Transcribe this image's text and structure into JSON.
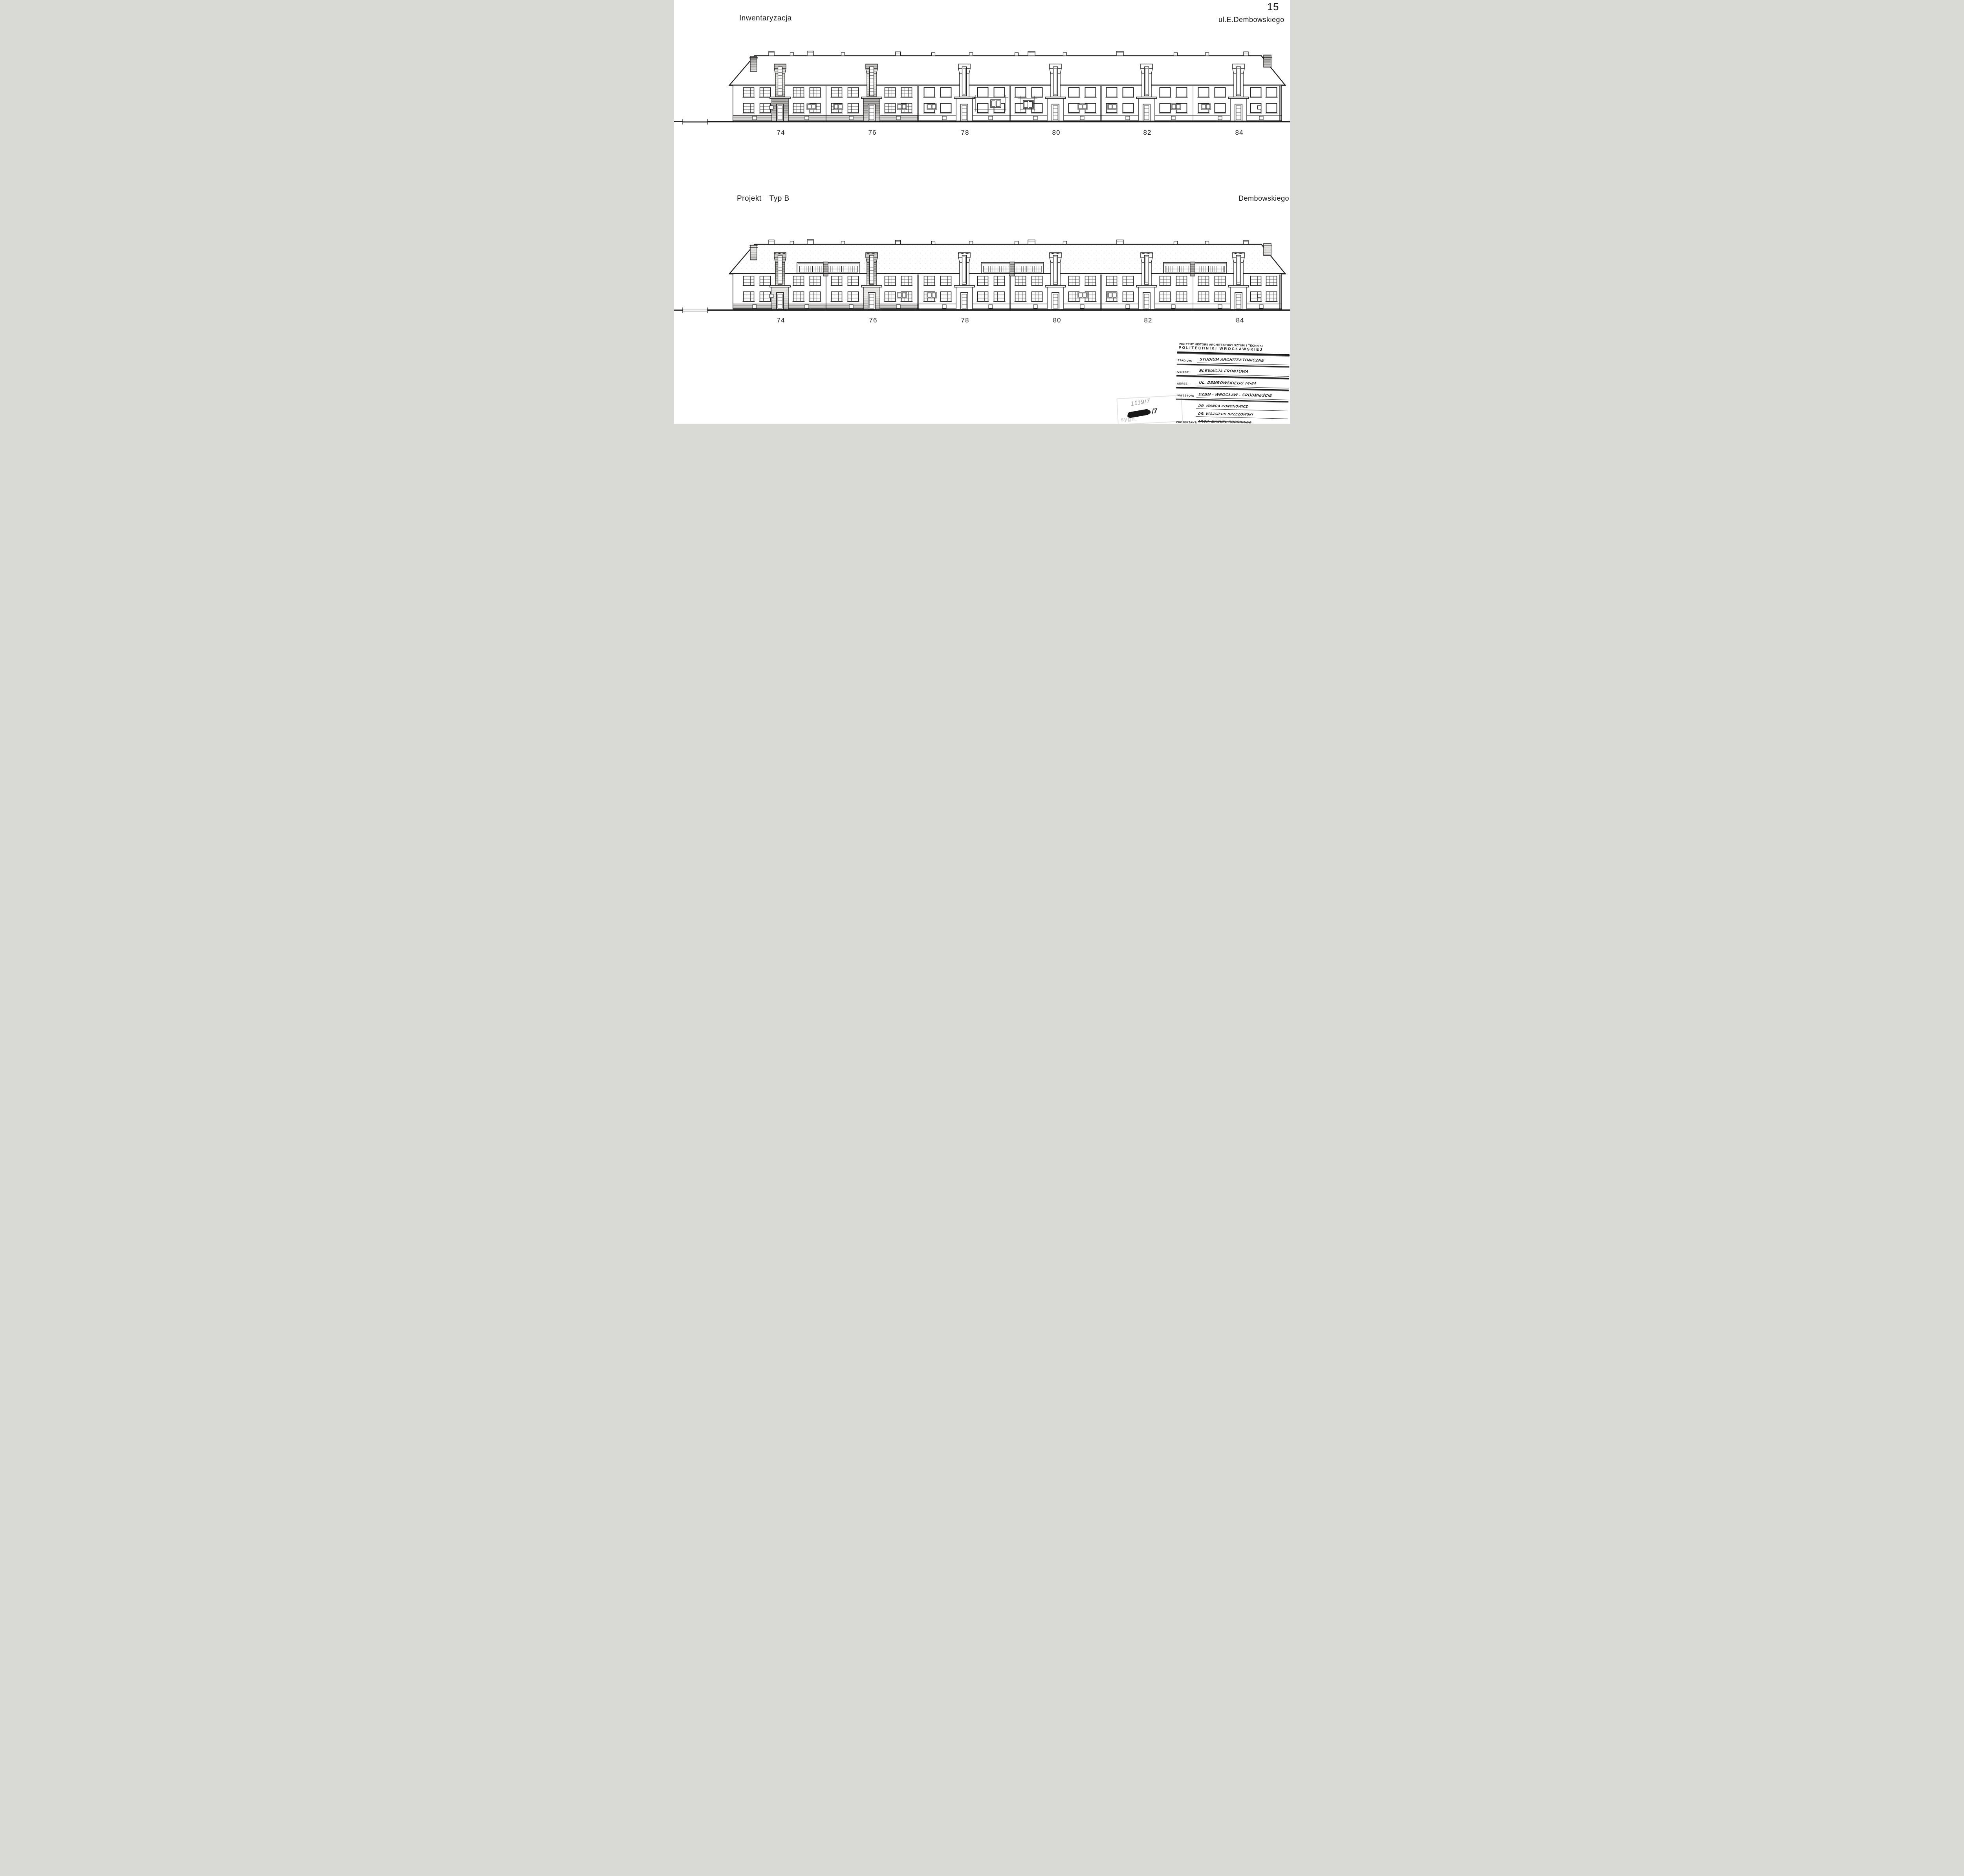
{
  "page": {
    "sheet_number": "15"
  },
  "top_drawing": {
    "title": "Inwentaryzacja",
    "street_label": "ul.E.Dembowskiego",
    "house_numbers": [
      "74",
      "76",
      "78",
      "80",
      "82",
      "84"
    ]
  },
  "bottom_drawing": {
    "title": "Projekt",
    "type_label": "Typ B",
    "street_label": "Dembowskiego",
    "house_numbers": [
      "74",
      "76",
      "78",
      "80",
      "82",
      "84"
    ]
  },
  "title_block": {
    "institute_line1": "INSTYTUT HISTORII ARCHITEKTURY SZTUKI I TECHNIKI",
    "institute_line2": "POLITECHNIKI WROCŁAWSKIEJ",
    "rows": [
      {
        "label": "STADIUM:",
        "value": "STUDIUM ARCHITEKTONICZNE"
      },
      {
        "label": "OBIEKT:",
        "value": "ELEWACJA FRONTOWA"
      },
      {
        "label": "ADRES:",
        "value": "UL. DEMBOWSKIEGO 74-84"
      },
      {
        "label": "INWESTOR:",
        "value": "DZBM - WROCŁAW - ŚRÓDMIEŚCIE"
      },
      {
        "label": "PROJEKTANT:",
        "values": [
          "DR. WANDA KONONOWICZ",
          "DR. WOJCIECH BRZEZOWSKI",
          "ARCH. MANUEL RODRIGUEZ"
        ]
      },
      {
        "label": "BRANZA:",
        "value": "ARCHITEKTURA"
      }
    ]
  },
  "archive_stamp": {
    "label": "sygn.",
    "pencil_number": "1119/7",
    "ink_number": "/7"
  },
  "colors": {
    "ink": "#1b1b1b",
    "paper": "#ffffff",
    "pencil": "#8b8b8b"
  }
}
